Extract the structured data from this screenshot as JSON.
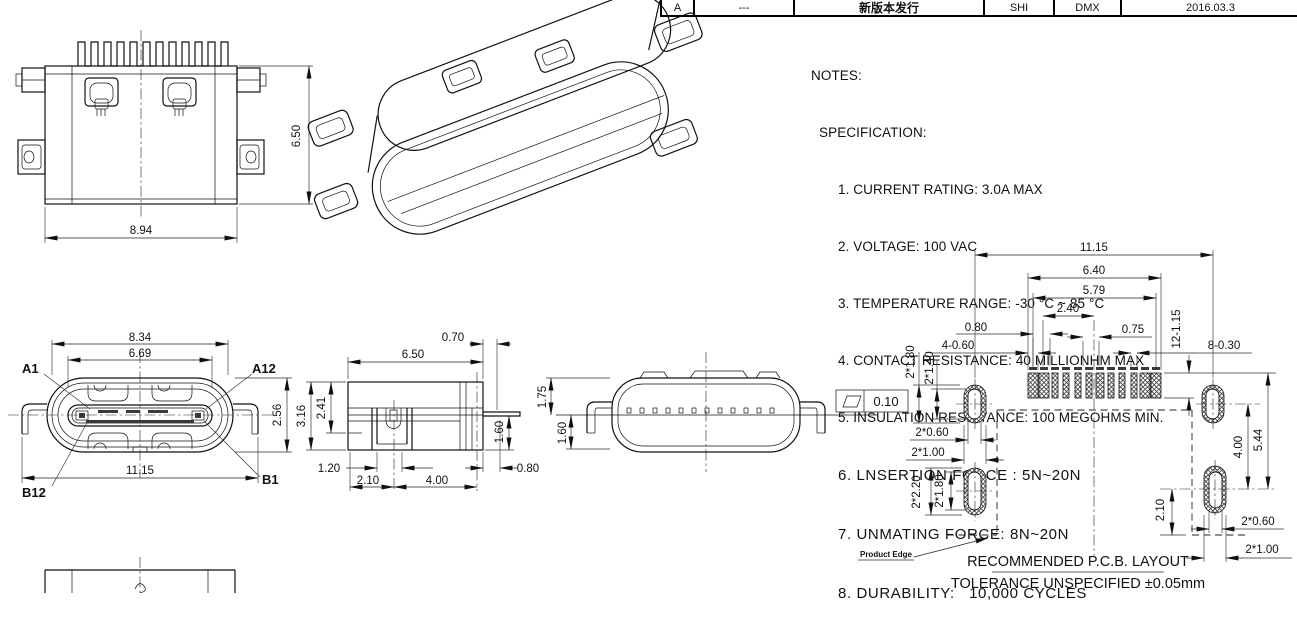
{
  "title_block": {
    "rev": "A",
    "ecn": "---",
    "description": "新版本发行",
    "drawn": "SHI",
    "checked": "DMX",
    "date": "2016.03.3"
  },
  "notes": {
    "heading": "NOTES:",
    "subheading": "SPECIFICATION:",
    "items": [
      "1. CURRENT RATING: 3.0A MAX",
      "2. VOLTAGE: 100 VAC",
      "3. TEMPERATURE RANGE: -30 °C ~ 85 °C",
      "4. CONTACT RESISTANCE: 40 MILLIONHM MAX",
      "5. INSULATION RESISTANCE: 100 MEGOHMS MIN.",
      "6. LNSERTION FORCE : 5N~20N",
      "7. UNMATING FORCE: 8N~20N",
      "8. DURABILITY:   10,000 CYCLES"
    ]
  },
  "top_view": {
    "dim_height": "6.50",
    "dim_width": "8.94"
  },
  "front_view": {
    "dim_shell": "8.34",
    "dim_opening": "6.69",
    "dim_height": "2.56",
    "dim_overall": "11.15",
    "a1": "A1",
    "a12": "A12",
    "b12": "B12",
    "b1": "B1"
  },
  "side_view": {
    "dim_tab": "0.70",
    "dim_width": "6.50",
    "dim_inner_h": "2.41",
    "dim_outer_h": "3.16",
    "dim_lead_h": "1.60",
    "dim_foot_w": "1.20",
    "dim_left_leg": "2.10",
    "dim_leg_span": "4.00",
    "dim_tab_len": "0.80"
  },
  "profile_view": {
    "dim_total_h": "1.75",
    "dim_body_h": "1.60",
    "flatness": "0.10"
  },
  "pcb": {
    "d_overall": "11.15",
    "d_span_outer": "6.40",
    "d_span": "5.79",
    "d_center": "2.40",
    "d_p080": "0.80",
    "d_p075": "0.75",
    "d_wide": "4-0.60",
    "d_narrow": "8-0.30",
    "d_padlen": "12-1.15",
    "d_s1h": "2*1.80",
    "d_s1hi": "2*1.40",
    "d_s1wi": "2*0.60",
    "d_s1w": "2*1.00",
    "d_s2h": "2*2.20",
    "d_s2hi": "2*1.80",
    "d_gap": "4.00",
    "d_span_v": "5.44",
    "d_edge": "2.10",
    "d_s3wi": "2*0.60",
    "d_s3w": "2*1.00",
    "product_edge": "Product Edge",
    "title": "RECOMMENDED   P.C.B.  LAYOUT",
    "tolerance": "TOLERANCE  UNSPECIFIED  ±0.05mm"
  }
}
